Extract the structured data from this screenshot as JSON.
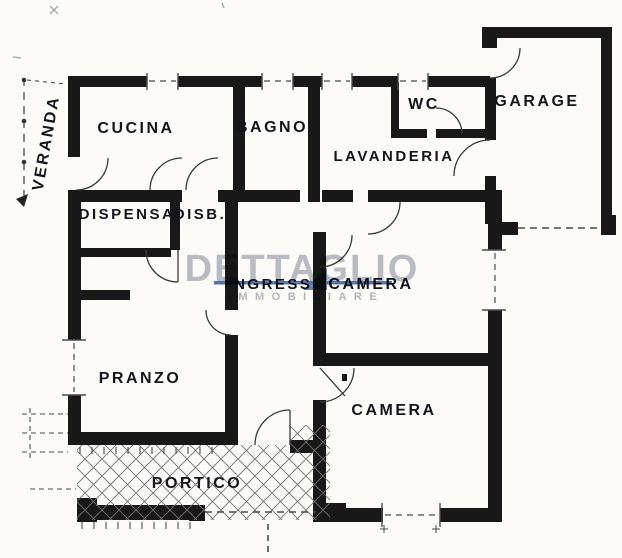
{
  "plan_title": "floor-plan",
  "colors": {
    "background": "#fcfbf8",
    "wall": "#181818",
    "label": "#14141c",
    "door_line": "#3a3a3a",
    "dash_line": "#4a4a4a",
    "hatch_line": "#707070",
    "watermark_text": "#b3b9c2",
    "watermark_sub": "#abb0b9",
    "watermark_accent": "#5577a8"
  },
  "rooms": [
    {
      "key": "veranda",
      "label": "VERANDA"
    },
    {
      "key": "cucina",
      "label": "CUCINA"
    },
    {
      "key": "bagno",
      "label": "BAGNO"
    },
    {
      "key": "wc",
      "label": "WC"
    },
    {
      "key": "garage",
      "label": "GARAGE"
    },
    {
      "key": "lavanderia",
      "label": "LAVANDERIA"
    },
    {
      "key": "dispensa",
      "label": "DISPENSA"
    },
    {
      "key": "disb",
      "label": "DISB."
    },
    {
      "key": "ingresso",
      "label": "INGRESSO"
    },
    {
      "key": "camera-1",
      "label": "CAMERA"
    },
    {
      "key": "pranzo",
      "label": "PRANZO"
    },
    {
      "key": "camera-2",
      "label": "CAMERA"
    },
    {
      "key": "portico",
      "label": "PORTICO"
    }
  ],
  "watermark": {
    "name": "DETTAGLIO",
    "subtitle": "IMMOBILIARE"
  }
}
